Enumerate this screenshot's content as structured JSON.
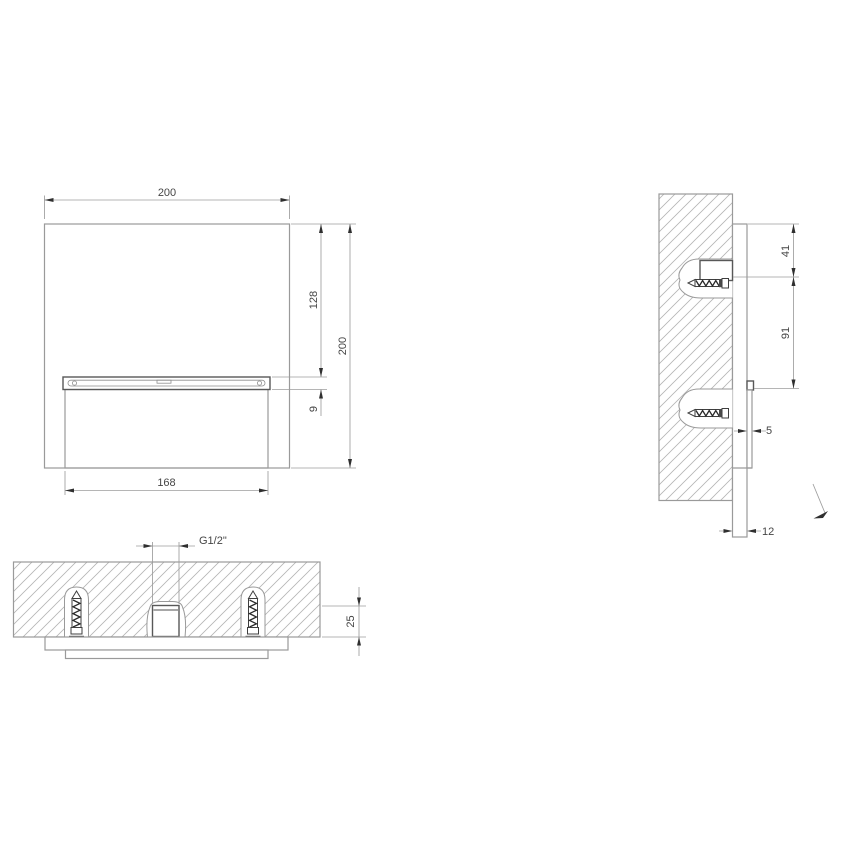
{
  "drawing": {
    "front": {
      "width": "200",
      "height": "200",
      "slot_top_offset": "128",
      "slot_height": "9",
      "slot_width": "168"
    },
    "side": {
      "top_to_anchor": "41",
      "anchor_to_spout": "91",
      "plate_offset": "5",
      "panel_thickness": "12"
    },
    "plan": {
      "thread": "G1/2\"",
      "recess_depth": "25"
    },
    "colors": {
      "line": "#9a9a9a",
      "dark_line": "#585858",
      "arrow": "#2f2f2f",
      "text": "#454545",
      "background": "#ffffff"
    }
  }
}
